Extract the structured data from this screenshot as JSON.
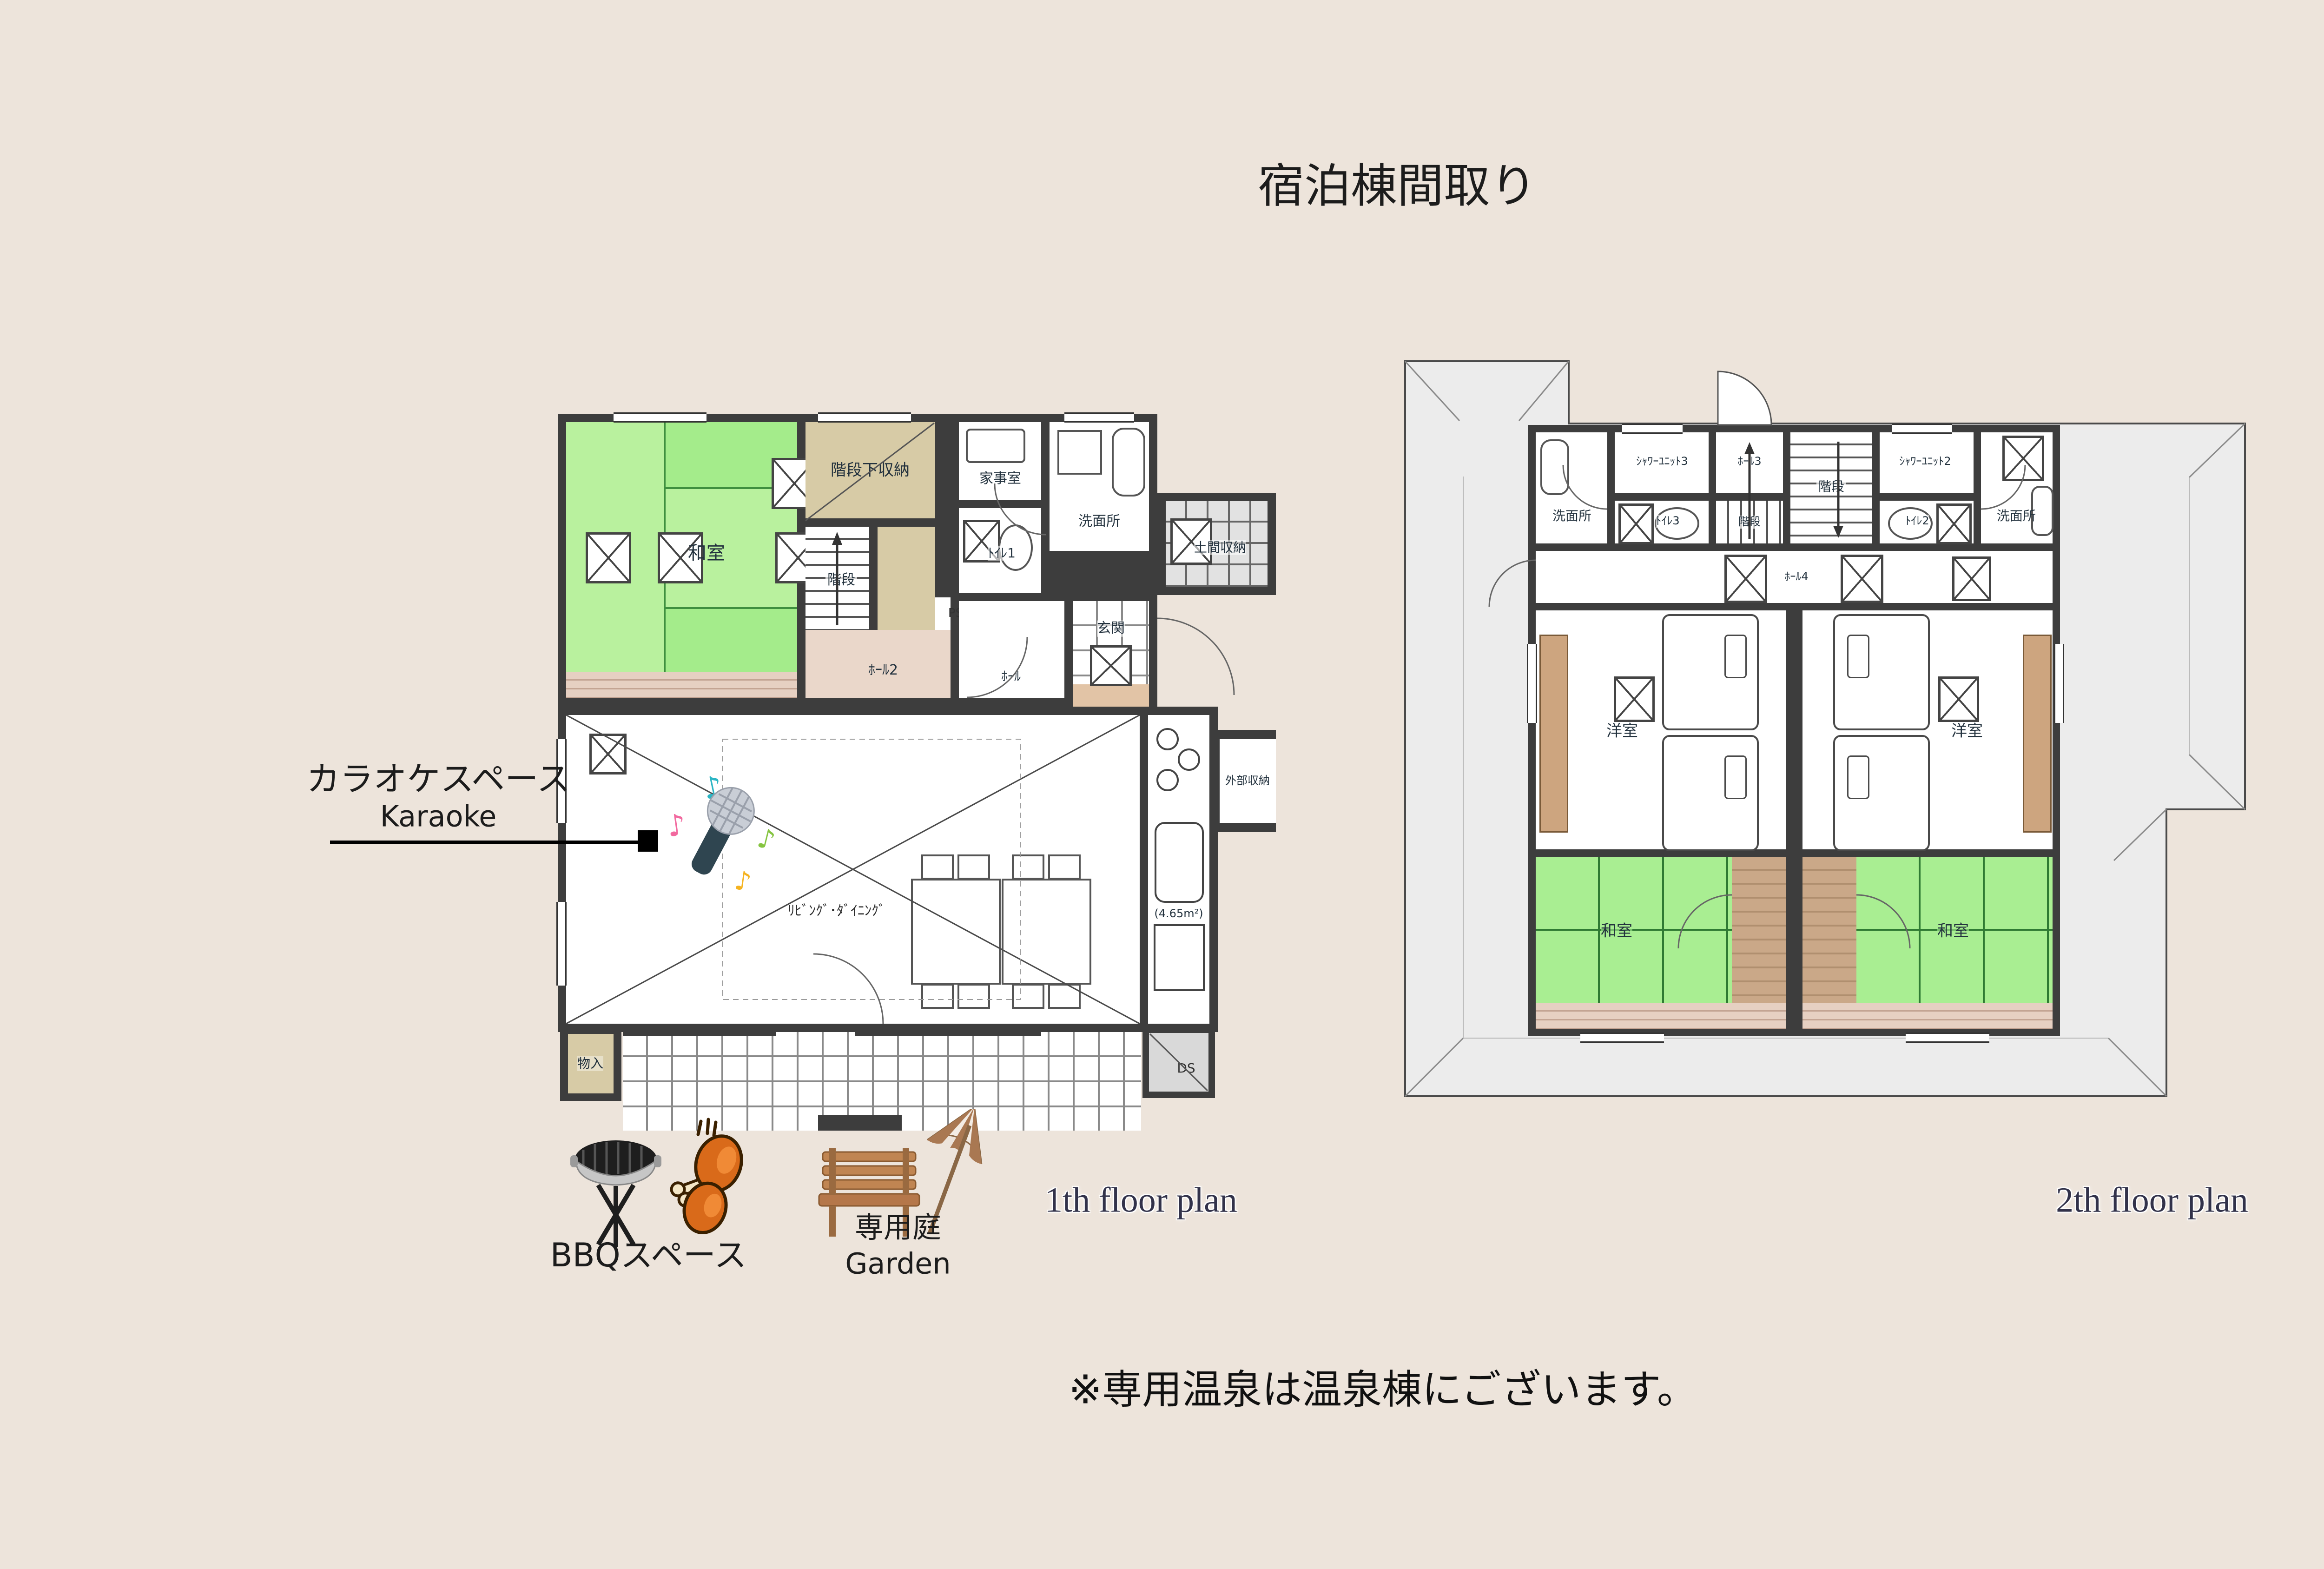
{
  "title": "宿泊棟間取り",
  "note": "※専用温泉は温泉棟にございます。",
  "annotations": {
    "karaoke_jp": "カラオケスペース",
    "karaoke_en": "Karaoke",
    "bbq": "BBQスペース",
    "garden_jp": "専用庭",
    "garden_en": "Garden"
  },
  "floor1": {
    "caption": "1th floor plan",
    "rooms": {
      "washitsu": "和室",
      "under_stair_storage": "階段下収納",
      "kaidan": "階段",
      "hall2": "ﾎｰﾙ2",
      "ps": "PS",
      "kajishitsu": "家事室",
      "senmenjo": "洗面所",
      "toilet1": "ﾄｲﾚ1",
      "doma_storage": "土間収納",
      "hall": "ﾎｰﾙ",
      "genkan": "玄関",
      "living": "ﾘﾋﾞﾝｸﾞ･ﾀﾞｲﾆﾝｸﾞ",
      "kitchen": "ｷｯﾁﾝ",
      "kitchen_area": "(4.65m²)",
      "gaibu_storage": "外部収納",
      "ds": "DS",
      "monoire": "物入"
    }
  },
  "floor2": {
    "caption": "2th floor plan",
    "rooms": {
      "senmenjo": "洗面所",
      "shower3": "ｼｬﾜｰﾕﾆｯﾄ3",
      "shower2": "ｼｬﾜｰﾕﾆｯﾄ2",
      "hall3": "ﾎｰﾙ3",
      "kaidan": "階段",
      "toilet3": "ﾄｲﾚ3",
      "toilet2": "ﾄｲﾚ2",
      "hall4": "ﾎｰﾙ4",
      "yoshitsu": "洋室",
      "washitsu": "和室"
    }
  },
  "colors": {
    "background": "#EDE4DB",
    "wall": "#3D3D3D",
    "tatami_green": "#A9EE92",
    "tatami_light": "#B9F19E",
    "storage_beige": "#D7CBA6",
    "engawa_pink": "#E6D0C2",
    "roof_gray": "#ECECEC",
    "wood_brown": "#CAA888",
    "closet_brown": "#CDA57F"
  }
}
